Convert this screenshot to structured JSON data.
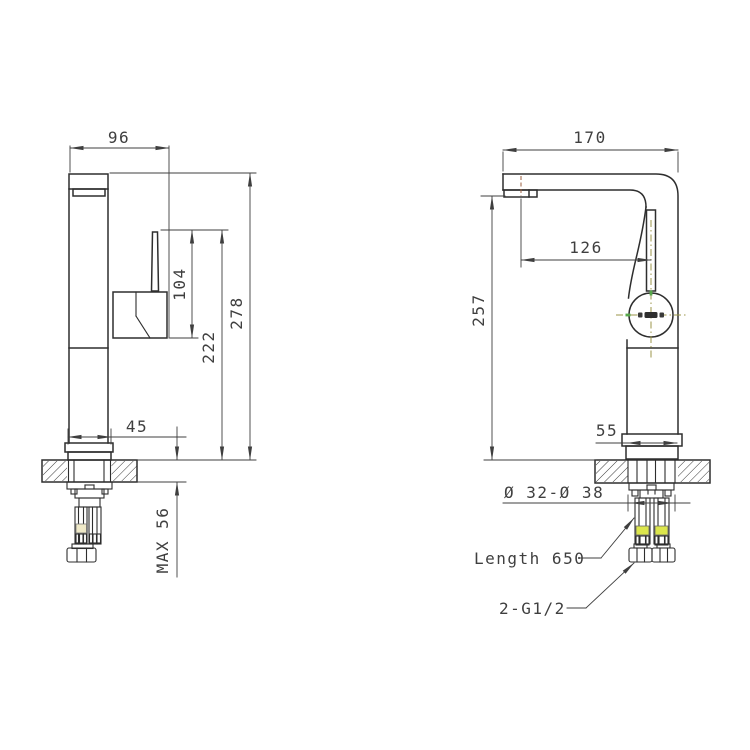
{
  "drawing": {
    "background": "#ffffff",
    "line_color": "#2e2e2e",
    "accent_colors": {
      "hose_highlight": "#dce64c",
      "hose_highlight_pale": "#efe9c8",
      "centerline_olive": "#9b9548",
      "centerline_brown": "#9b5f3f",
      "green_tick": "#57a84b"
    },
    "front_view": {
      "dim_width_top": "96",
      "dim_handle_height": "104",
      "dim_height_to_lever": "222",
      "dim_total_height": "278",
      "dim_base_width": "45",
      "dim_max_deck_thickness": "MAX 56"
    },
    "side_view": {
      "dim_spout_reach": "170",
      "dim_spout_tip_to_axis": "126",
      "dim_spout_height": "257",
      "dim_base_depth": "55",
      "dim_mounting_hole": "Ø 32-Ø 38",
      "dim_hose_length": "Length 650",
      "dim_hose_thread": "2-G1/2"
    }
  }
}
